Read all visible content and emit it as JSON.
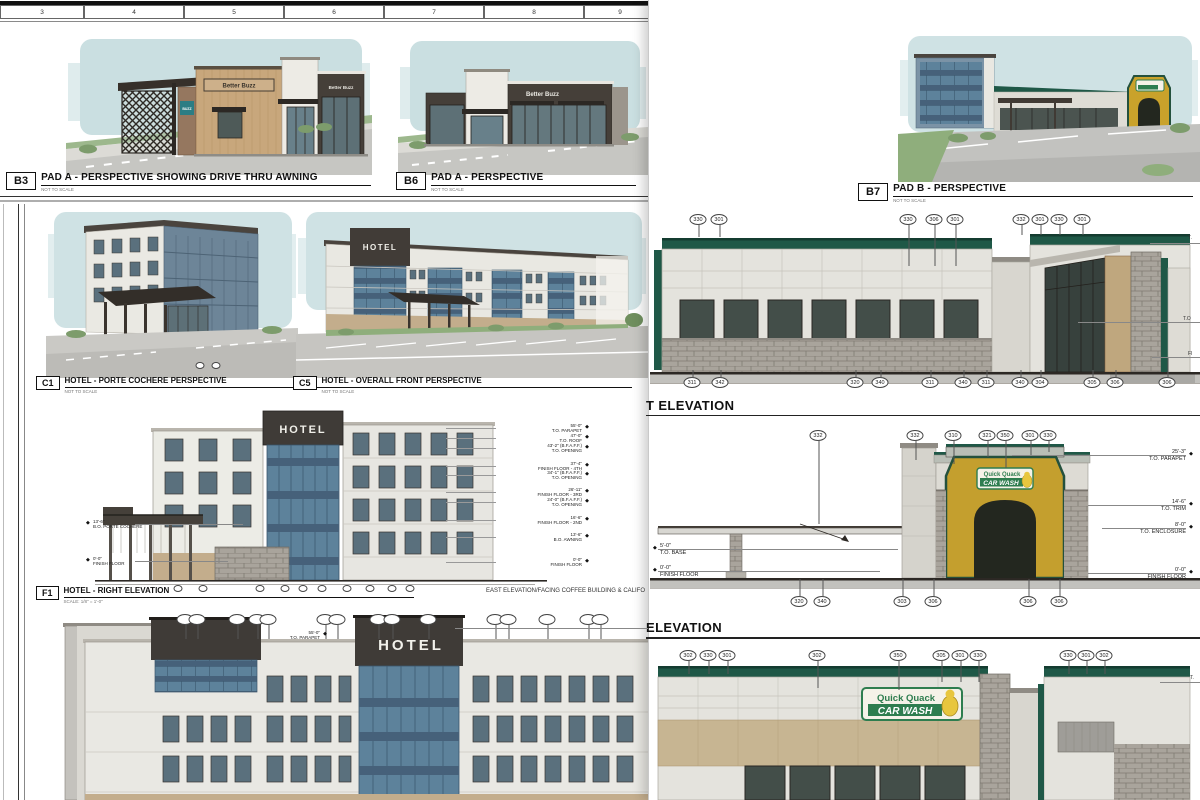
{
  "ruler": [
    {
      "t": "3",
      "x": 0,
      "w": 84
    },
    {
      "t": "4",
      "x": 84,
      "w": 100
    },
    {
      "t": "5",
      "x": 184,
      "w": 100
    },
    {
      "t": "6",
      "x": 284,
      "w": 100
    },
    {
      "t": "7",
      "x": 384,
      "w": 100
    },
    {
      "t": "8",
      "x": 484,
      "w": 100
    },
    {
      "t": "9",
      "x": 584,
      "w": 72
    }
  ],
  "panels": {
    "b3": {
      "code": "B3",
      "title": "PAD A - PERSPECTIVE SHOWING DRIVE THRU AWNING",
      "scale": "NOT TO SCALE"
    },
    "b6": {
      "code": "B6",
      "title": "PAD A - PERSPECTIVE",
      "scale": "NOT TO SCALE"
    },
    "b7": {
      "code": "B7",
      "title": "PAD B - PERSPECTIVE",
      "scale": "NOT TO SCALE"
    },
    "c1": {
      "code": "C1",
      "title": "HOTEL - PORTE COCHERE PERSPECTIVE",
      "scale": "NOT TO SCALE"
    },
    "c5": {
      "code": "C5",
      "title": "HOTEL - OVERALL FRONT PERSPECTIVE",
      "scale": "NOT TO SCALE"
    },
    "f1": {
      "code": "F1",
      "title": "HOTEL - RIGHT ELEVATION",
      "scale": "SCALE: 1/8\" = 1'-0\""
    }
  },
  "notes": {
    "f1_right": "EAST ELEVATION/FACING COFFEE BUILDING & CALIFO"
  },
  "brand": {
    "better_buzz": "Better Buzz",
    "buzz": "BUZZ",
    "hotel": "HOTEL",
    "qq1": "Quick Quack",
    "qq2": "CAR WASH"
  },
  "headings": {
    "east": "T ELEVATION",
    "south": "ELEVATION"
  },
  "co": {
    "east_top": [
      {
        "t": "330",
        "x": 698,
        "h": 13
      },
      {
        "t": "301",
        "x": 719,
        "h": 13
      },
      {
        "t": "330",
        "x": 908,
        "h": 42
      },
      {
        "t": "306",
        "x": 934,
        "h": 42
      },
      {
        "t": "301",
        "x": 955,
        "h": 42
      },
      {
        "t": "332",
        "x": 1021,
        "h": 11
      },
      {
        "t": "301",
        "x": 1040,
        "h": 11
      },
      {
        "t": "330",
        "x": 1059,
        "h": 11
      },
      {
        "t": "301",
        "x": 1082,
        "h": 11
      }
    ],
    "east_bot": [
      {
        "t": "311",
        "x": 692,
        "h": 8
      },
      {
        "t": "342",
        "x": 720,
        "h": 8
      },
      {
        "t": "320",
        "x": 855,
        "h": 8
      },
      {
        "t": "340",
        "x": 880,
        "h": 8
      },
      {
        "t": "311",
        "x": 930,
        "h": 8
      },
      {
        "t": "340",
        "x": 963,
        "h": 8
      },
      {
        "t": "311",
        "x": 986,
        "h": 8
      },
      {
        "t": "340",
        "x": 1020,
        "h": 8
      },
      {
        "t": "304",
        "x": 1040,
        "h": 8
      },
      {
        "t": "305",
        "x": 1092,
        "h": 8
      },
      {
        "t": "306",
        "x": 1115,
        "h": 8
      },
      {
        "t": "306",
        "x": 1167,
        "h": 20
      }
    ],
    "south_top": [
      {
        "t": "332",
        "x": 818,
        "h": 84
      },
      {
        "t": "332",
        "x": 915,
        "h": 20
      },
      {
        "t": "310",
        "x": 953,
        "h": 24
      },
      {
        "t": "321",
        "x": 987,
        "h": 17
      },
      {
        "t": "350",
        "x": 1005,
        "h": 28
      },
      {
        "t": "301",
        "x": 1030,
        "h": 15
      },
      {
        "t": "330",
        "x": 1048,
        "h": 12
      }
    ],
    "south_bot": [
      {
        "t": "320",
        "x": 799,
        "h": 18
      },
      {
        "t": "340",
        "x": 822,
        "h": 18
      },
      {
        "t": "303",
        "x": 902,
        "h": 18
      },
      {
        "t": "306",
        "x": 933,
        "h": 18
      },
      {
        "t": "306",
        "x": 1028,
        "h": 18
      },
      {
        "t": "306",
        "x": 1059,
        "h": 18
      }
    ],
    "north_top": [
      {
        "t": "302",
        "x": 688,
        "h": 14
      },
      {
        "t": "330",
        "x": 708,
        "h": 14
      },
      {
        "t": "301",
        "x": 727,
        "h": 14
      },
      {
        "t": "302",
        "x": 817,
        "h": 28
      },
      {
        "t": "350",
        "x": 898,
        "h": 30
      },
      {
        "t": "305",
        "x": 941,
        "h": 22
      },
      {
        "t": "301",
        "x": 960,
        "h": 22
      },
      {
        "t": "330",
        "x": 978,
        "h": 22
      },
      {
        "t": "330",
        "x": 1068,
        "h": 14
      },
      {
        "t": "301",
        "x": 1086,
        "h": 14
      },
      {
        "t": "302",
        "x": 1104,
        "h": 14
      }
    ],
    "hotel_top": [
      {
        "t": "",
        "x": 185,
        "h": 15
      },
      {
        "t": "",
        "x": 197,
        "h": 15
      },
      {
        "t": "",
        "x": 237,
        "h": 15
      },
      {
        "t": "",
        "x": 257,
        "h": 15
      },
      {
        "t": "",
        "x": 268,
        "h": 15
      },
      {
        "t": "",
        "x": 325,
        "h": 15
      },
      {
        "t": "",
        "x": 337,
        "h": 15
      },
      {
        "t": "",
        "x": 378,
        "h": 15
      },
      {
        "t": "",
        "x": 392,
        "h": 15
      },
      {
        "t": "",
        "x": 428,
        "h": 15
      },
      {
        "t": "",
        "x": 495,
        "h": 15
      },
      {
        "t": "",
        "x": 508,
        "h": 15
      },
      {
        "t": "",
        "x": 547,
        "h": 15
      },
      {
        "t": "",
        "x": 588,
        "h": 15
      },
      {
        "t": "",
        "x": 600,
        "h": 15
      }
    ],
    "f1_bot": [
      {
        "t": "",
        "x": 178
      },
      {
        "t": "",
        "x": 203
      },
      {
        "t": "",
        "x": 260
      },
      {
        "t": "",
        "x": 285
      },
      {
        "t": "",
        "x": 303
      },
      {
        "t": "",
        "x": 322
      },
      {
        "t": "",
        "x": 347
      },
      {
        "t": "",
        "x": 370
      },
      {
        "t": "",
        "x": 392
      },
      {
        "t": "",
        "x": 410
      }
    ],
    "c1_bot": [
      {
        "t": "",
        "x": 200
      },
      {
        "t": "",
        "x": 216
      }
    ]
  },
  "dims": {
    "south_right": [
      {
        "v": "25'-3\"",
        "l": "T.O. PARAPET",
        "y": 449
      },
      {
        "v": "14'-6\"",
        "l": "T.O. TRIM",
        "y": 499
      },
      {
        "v": "8'-0\"",
        "l": "T.O. ENCLOSURE",
        "y": 522
      },
      {
        "v": "0'-0\"",
        "l": "FINISH FLOOR",
        "y": 567
      }
    ],
    "south_left": [
      {
        "v": "5'-0\"",
        "l": "T.O. BASE",
        "y": 543
      },
      {
        "v": "0'-0\"",
        "l": "FINISH FLOOR",
        "y": 565
      }
    ],
    "f1_right": [
      {
        "v": "55'-0\"",
        "l": "T.O. PARAPET",
        "y": 423
      },
      {
        "v": "47'-0\"",
        "l": "T.O. ROOF",
        "y": 433
      },
      {
        "v": "43'-2\" (B.F.A.F.F.)",
        "l": "T.O. OPENING",
        "y": 443
      },
      {
        "v": "37'-4\"",
        "l": "FINISH FLOOR - 4TH",
        "y": 461
      },
      {
        "v": "34'-1\" (B.F.A.F.F.)",
        "l": "T.O. OPENING",
        "y": 470
      },
      {
        "v": "26'-11\"",
        "l": "FINISH FLOOR - 3RD",
        "y": 487
      },
      {
        "v": "24'-0\" (B.F.A.F.F.)",
        "l": "T.O. OPENING",
        "y": 497
      },
      {
        "v": "16'-6\"",
        "l": "FINISH FLOOR - 2ND",
        "y": 515
      },
      {
        "v": "13'-6\"",
        "l": "B.O. AWNING",
        "y": 532
      },
      {
        "v": "0'-0\"",
        "l": "FINISH FLOOR",
        "y": 557
      }
    ],
    "f1_left": [
      {
        "v": "13'-6\"",
        "l": "B.O. PORTE COCHERE",
        "y": 519
      },
      {
        "v": "0'-0\"",
        "l": "FINISH FLOOR",
        "y": 556
      }
    ],
    "hotel_parapet": {
      "v": "55'-0\"",
      "l": "T.O. PARAPET"
    }
  },
  "cut_labels": [
    {
      "t": "T.",
      "x": 1188,
      "y": 235
    },
    {
      "t": "T.O",
      "x": 1183,
      "y": 316
    },
    {
      "t": "FI",
      "x": 1188,
      "y": 351
    },
    {
      "t": "T.",
      "x": 1190,
      "y": 675
    }
  ],
  "colors": {
    "parapet_green": "#1f5847",
    "qq_green": "#2e7d4f",
    "qq_gold": "#c49f2e",
    "hotel_blue": "#5d829b",
    "sky": "#cfe2e4",
    "stone_grey": "#a9a49c",
    "tan": "#c7b592"
  }
}
